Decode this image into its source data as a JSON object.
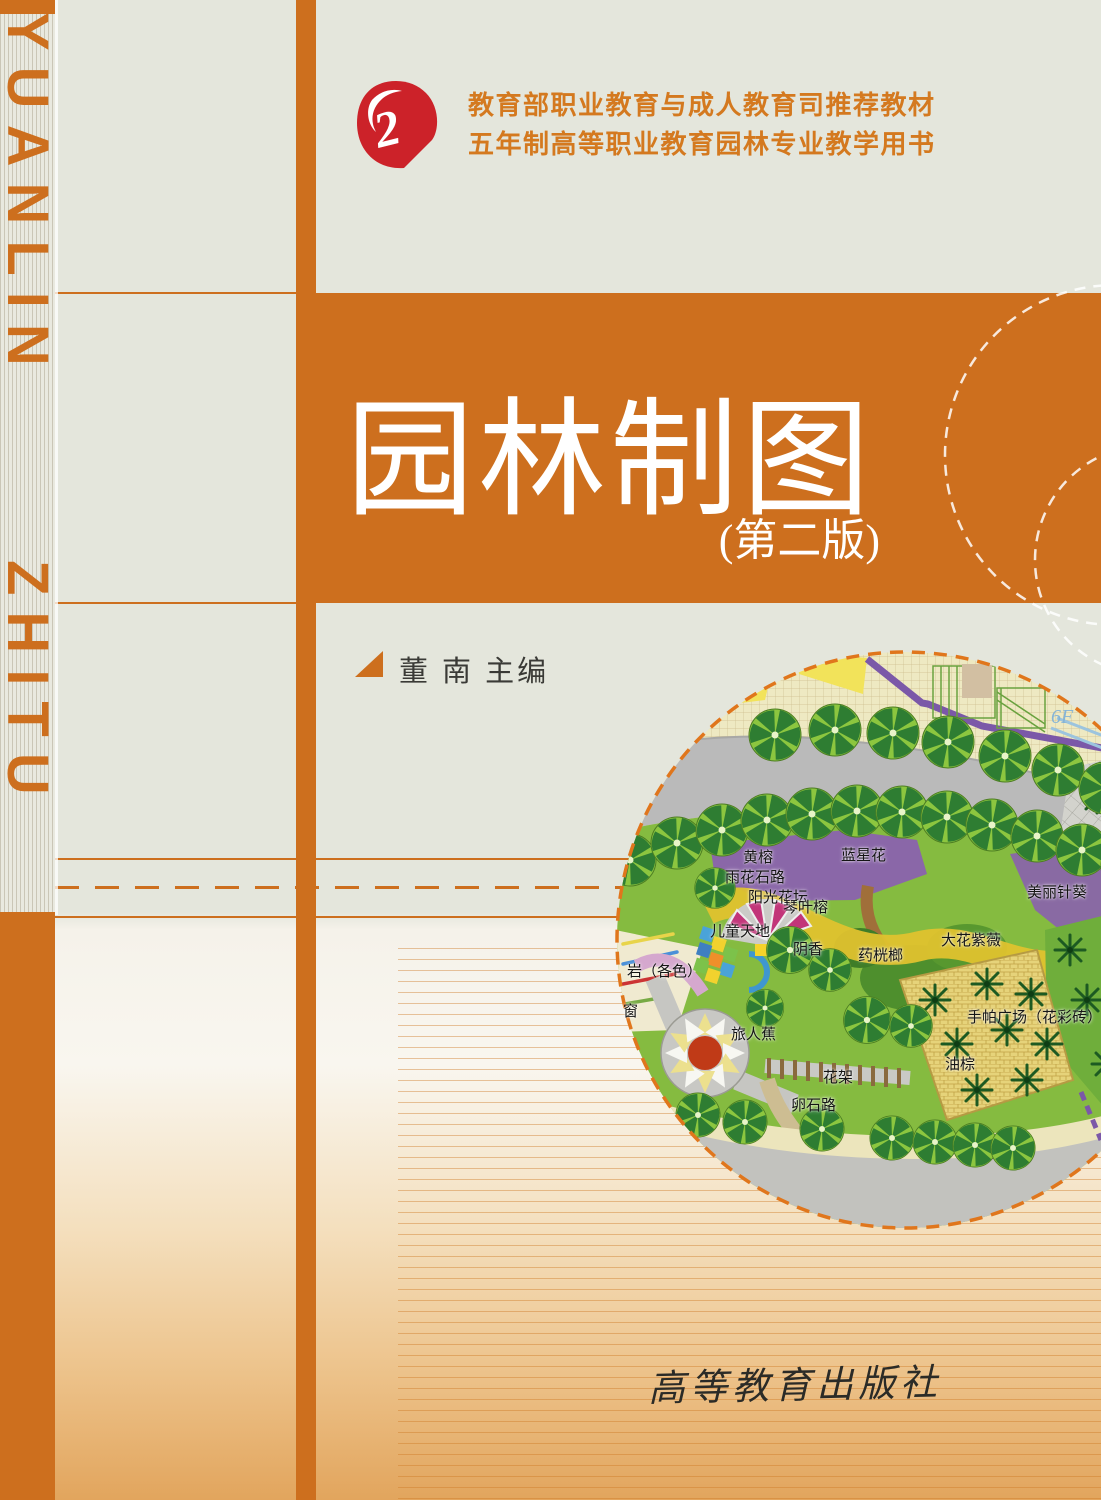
{
  "cover": {
    "series_line1": "教育部职业教育与成人教育司推荐教材",
    "series_line2": "五年制高等职业教育园林专业教学用书",
    "title": "园林制图",
    "edition": "(第二版)",
    "author_line": "董  南  主编",
    "publisher": "高等教育出版社",
    "logo_glyph": "2",
    "spine_word_top": "YUANLIN",
    "spine_word_bottom": "ZHITU",
    "colors": {
      "accent_orange": "#cd6f1e",
      "series_text": "#d4791f",
      "logo_red": "#cc2229",
      "background_gray": "#e4e6dc",
      "bottom_gradient": "#e2a55d",
      "title_text": "#ffffff"
    }
  },
  "plan": {
    "labels": [
      {
        "text": "6F",
        "x": 436,
        "y": 58,
        "cls": "blue"
      },
      {
        "text": "黄榕",
        "x": 128,
        "y": 198
      },
      {
        "text": "雨花石路",
        "x": 110,
        "y": 218
      },
      {
        "text": "阳光花坛",
        "x": 133,
        "y": 238
      },
      {
        "text": "蓝星花",
        "x": 226,
        "y": 196
      },
      {
        "text": "琴叶榕",
        "x": 168,
        "y": 248
      },
      {
        "text": "美丽针葵",
        "x": 412,
        "y": 233
      },
      {
        "text": "儿童天地",
        "x": 95,
        "y": 272
      },
      {
        "text": "阴香",
        "x": 178,
        "y": 290
      },
      {
        "text": "药桄榔",
        "x": 243,
        "y": 296
      },
      {
        "text": "大花紫薇",
        "x": 326,
        "y": 281
      },
      {
        "text": "岩（各色）",
        "x": 12,
        "y": 312
      },
      {
        "text": "窗",
        "x": 8,
        "y": 352
      },
      {
        "text": "旅人蕉",
        "x": 116,
        "y": 375
      },
      {
        "text": "手帕广场（花彩砖）",
        "x": 352,
        "y": 358
      },
      {
        "text": "油棕",
        "x": 330,
        "y": 405
      },
      {
        "text": "花架",
        "x": 208,
        "y": 418
      },
      {
        "text": "卵石路",
        "x": 176,
        "y": 446
      }
    ]
  }
}
